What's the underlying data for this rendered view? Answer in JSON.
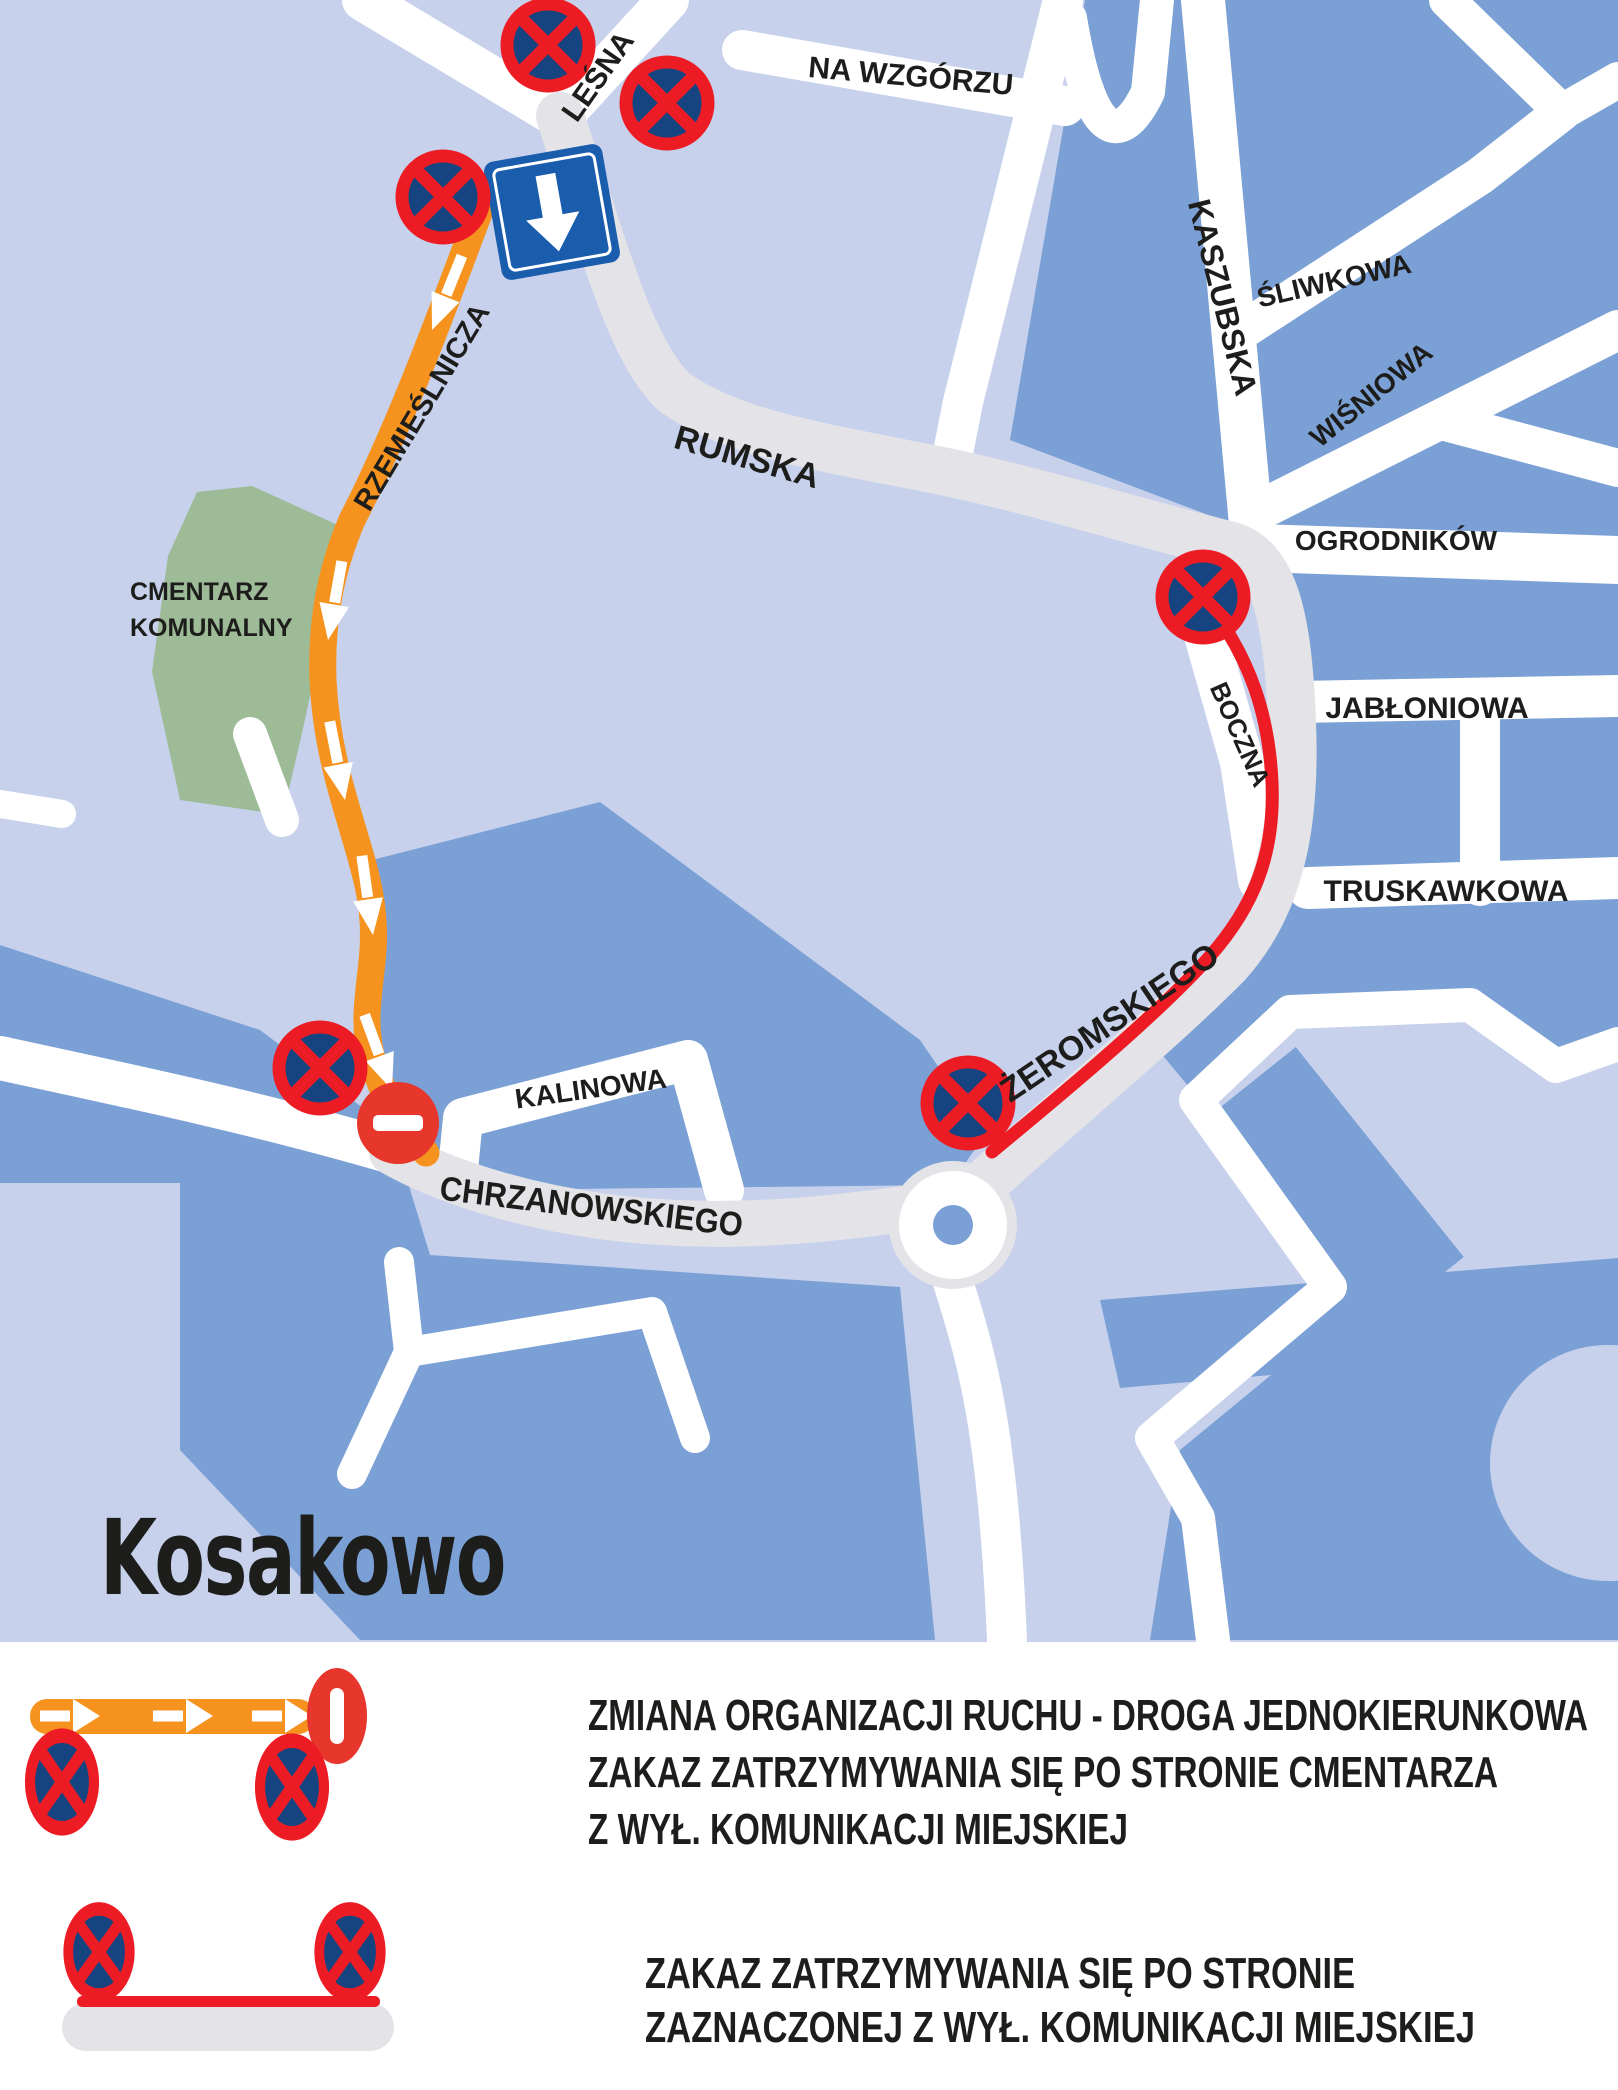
{
  "title": "Kosakowo",
  "map": {
    "streets": {
      "lesna": "LEŚNA",
      "na_wzgorzu": "NA WZGÓRZU",
      "kaszubska": "KASZUBSKA",
      "sliwkowa": "ŚLIWKOWA",
      "wisniowa": "WIŚNIOWA",
      "rumska": "RUMSKA",
      "ogrodnikow": "OGRODNIKÓW",
      "boczna": "BOCZNA",
      "jabloniowa": "JABŁONIOWA",
      "truskawkowa": "TRUSKAWKOWA",
      "zeromskiego": "ŻEROMSKIEGO",
      "rzemieslnicza": "RZEMIEŚLNICZA",
      "kalinowa": "KALINOWA",
      "chrzanowskiego": "CHRZANOWSKIEGO"
    },
    "cemetery": {
      "line1": "CMENTARZ",
      "line2": "KOMUNALNY"
    },
    "icons": {
      "no_stopping": "no-stopping-sign",
      "one_way": "one-way-down-sign",
      "no_entry": "no-entry-sign"
    }
  },
  "legend": {
    "one_way_route": {
      "line1": "ZMIANA ORGANIZACJI RUCHU - DROGA JEDNOKIERUNKOWA",
      "line2": "ZAKAZ ZATRZYMYWANIA SIĘ PO STRONIE CMENTARZA",
      "line3": "Z WYŁ. KOMUNIKACJI MIEJSKIEJ"
    },
    "no_stopping_route": {
      "line1": "ZAKAZ ZATRZYMYWANIA SIĘ PO STRONIE",
      "line2": "ZAZNACZONEJ Z WYŁ. KOMUNIKACJI MIEJSKIEJ"
    }
  },
  "colors": {
    "background_light": "#c7d1ec",
    "block_blue": "#7ba0d5",
    "road_gray": "#e4e4e8",
    "cemetery_green": "#9dbb97",
    "route_orange": "#f6921e",
    "route_red": "#ed1c24",
    "sign_navy": "#164480",
    "one_way_blue": "#1a5dad",
    "no_entry_red": "#e7372c",
    "text_black": "#1d1d1b"
  }
}
